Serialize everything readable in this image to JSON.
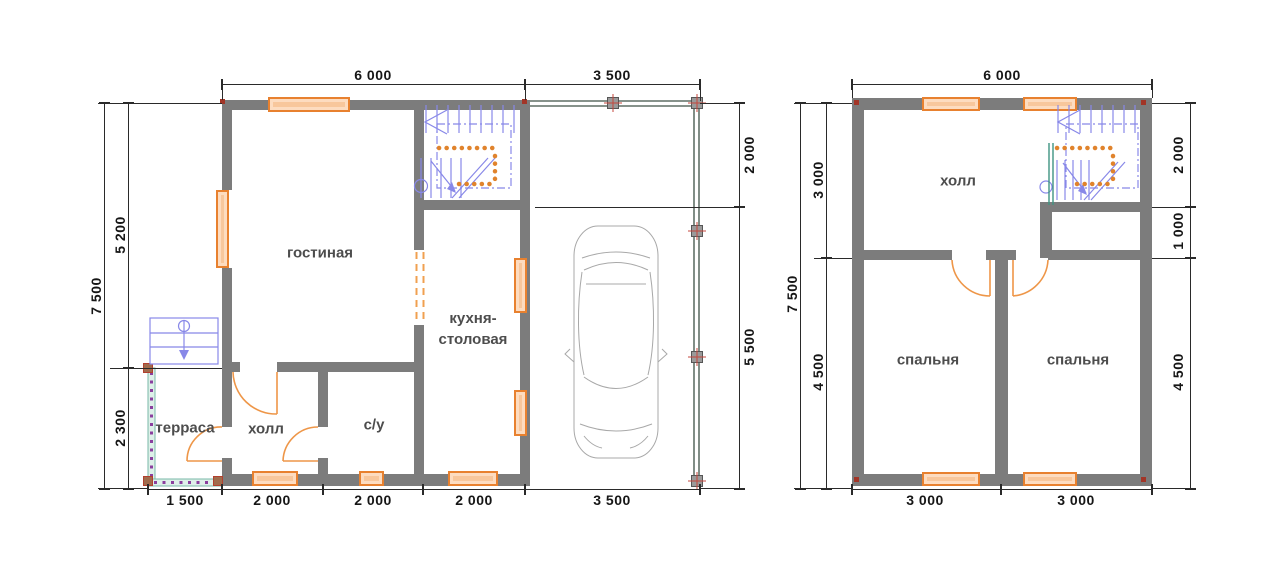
{
  "plan1": {
    "rooms": {
      "living": "гостиная",
      "kitchen": "кухня-\nстоловая",
      "terrace": "терраса",
      "hall": "холл",
      "wc": "с/у"
    },
    "dims": {
      "top": [
        "6 000",
        "3 500"
      ],
      "left_total": "7 500",
      "left": [
        "5 200",
        "2 300"
      ],
      "right": [
        "2 000",
        "5 500"
      ],
      "bottom": [
        "1 500",
        "2 000",
        "2 000",
        "2 000",
        "3 500"
      ]
    }
  },
  "plan2": {
    "rooms": {
      "hall": "холл",
      "bedroom_left": "спальня",
      "bedroom_right": "спальня"
    },
    "dims": {
      "top": [
        "6 000"
      ],
      "left_total": "7 500",
      "left": [
        "3 000",
        "4 500"
      ],
      "right": [
        "2 000",
        "1 000",
        "4 500"
      ],
      "bottom": [
        "3 000",
        "3 000"
      ]
    }
  }
}
